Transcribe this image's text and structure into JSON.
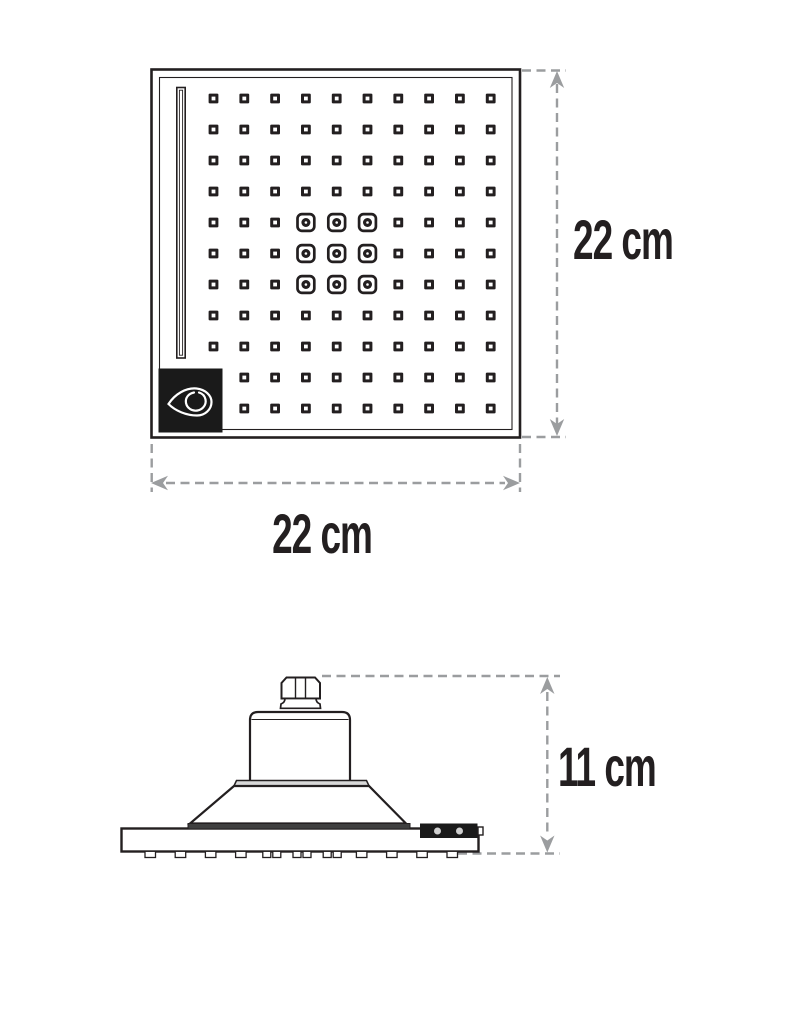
{
  "labels": {
    "top_view_height": "22 cm",
    "top_view_width": "22 cm",
    "side_view_height": "11 cm"
  },
  "colors": {
    "line": "#231f20",
    "dimension": "#9b9d9f",
    "logo_background": "#1a1a1a",
    "background": "#ffffff"
  },
  "icons": {
    "logo": "water-drop-logo"
  },
  "top_view": {
    "nozzle_grid": {
      "columns": 10,
      "rows": 11,
      "large_nozzle_rows": [
        4,
        5,
        6
      ],
      "large_nozzle_columns": [
        3,
        4,
        5
      ],
      "hidden_cells": [
        [
          9,
          0
        ],
        [
          10,
          0
        ]
      ]
    }
  },
  "side_view": {
    "tab_count": 11,
    "double_tabs": [
      4,
      5,
      6
    ]
  }
}
